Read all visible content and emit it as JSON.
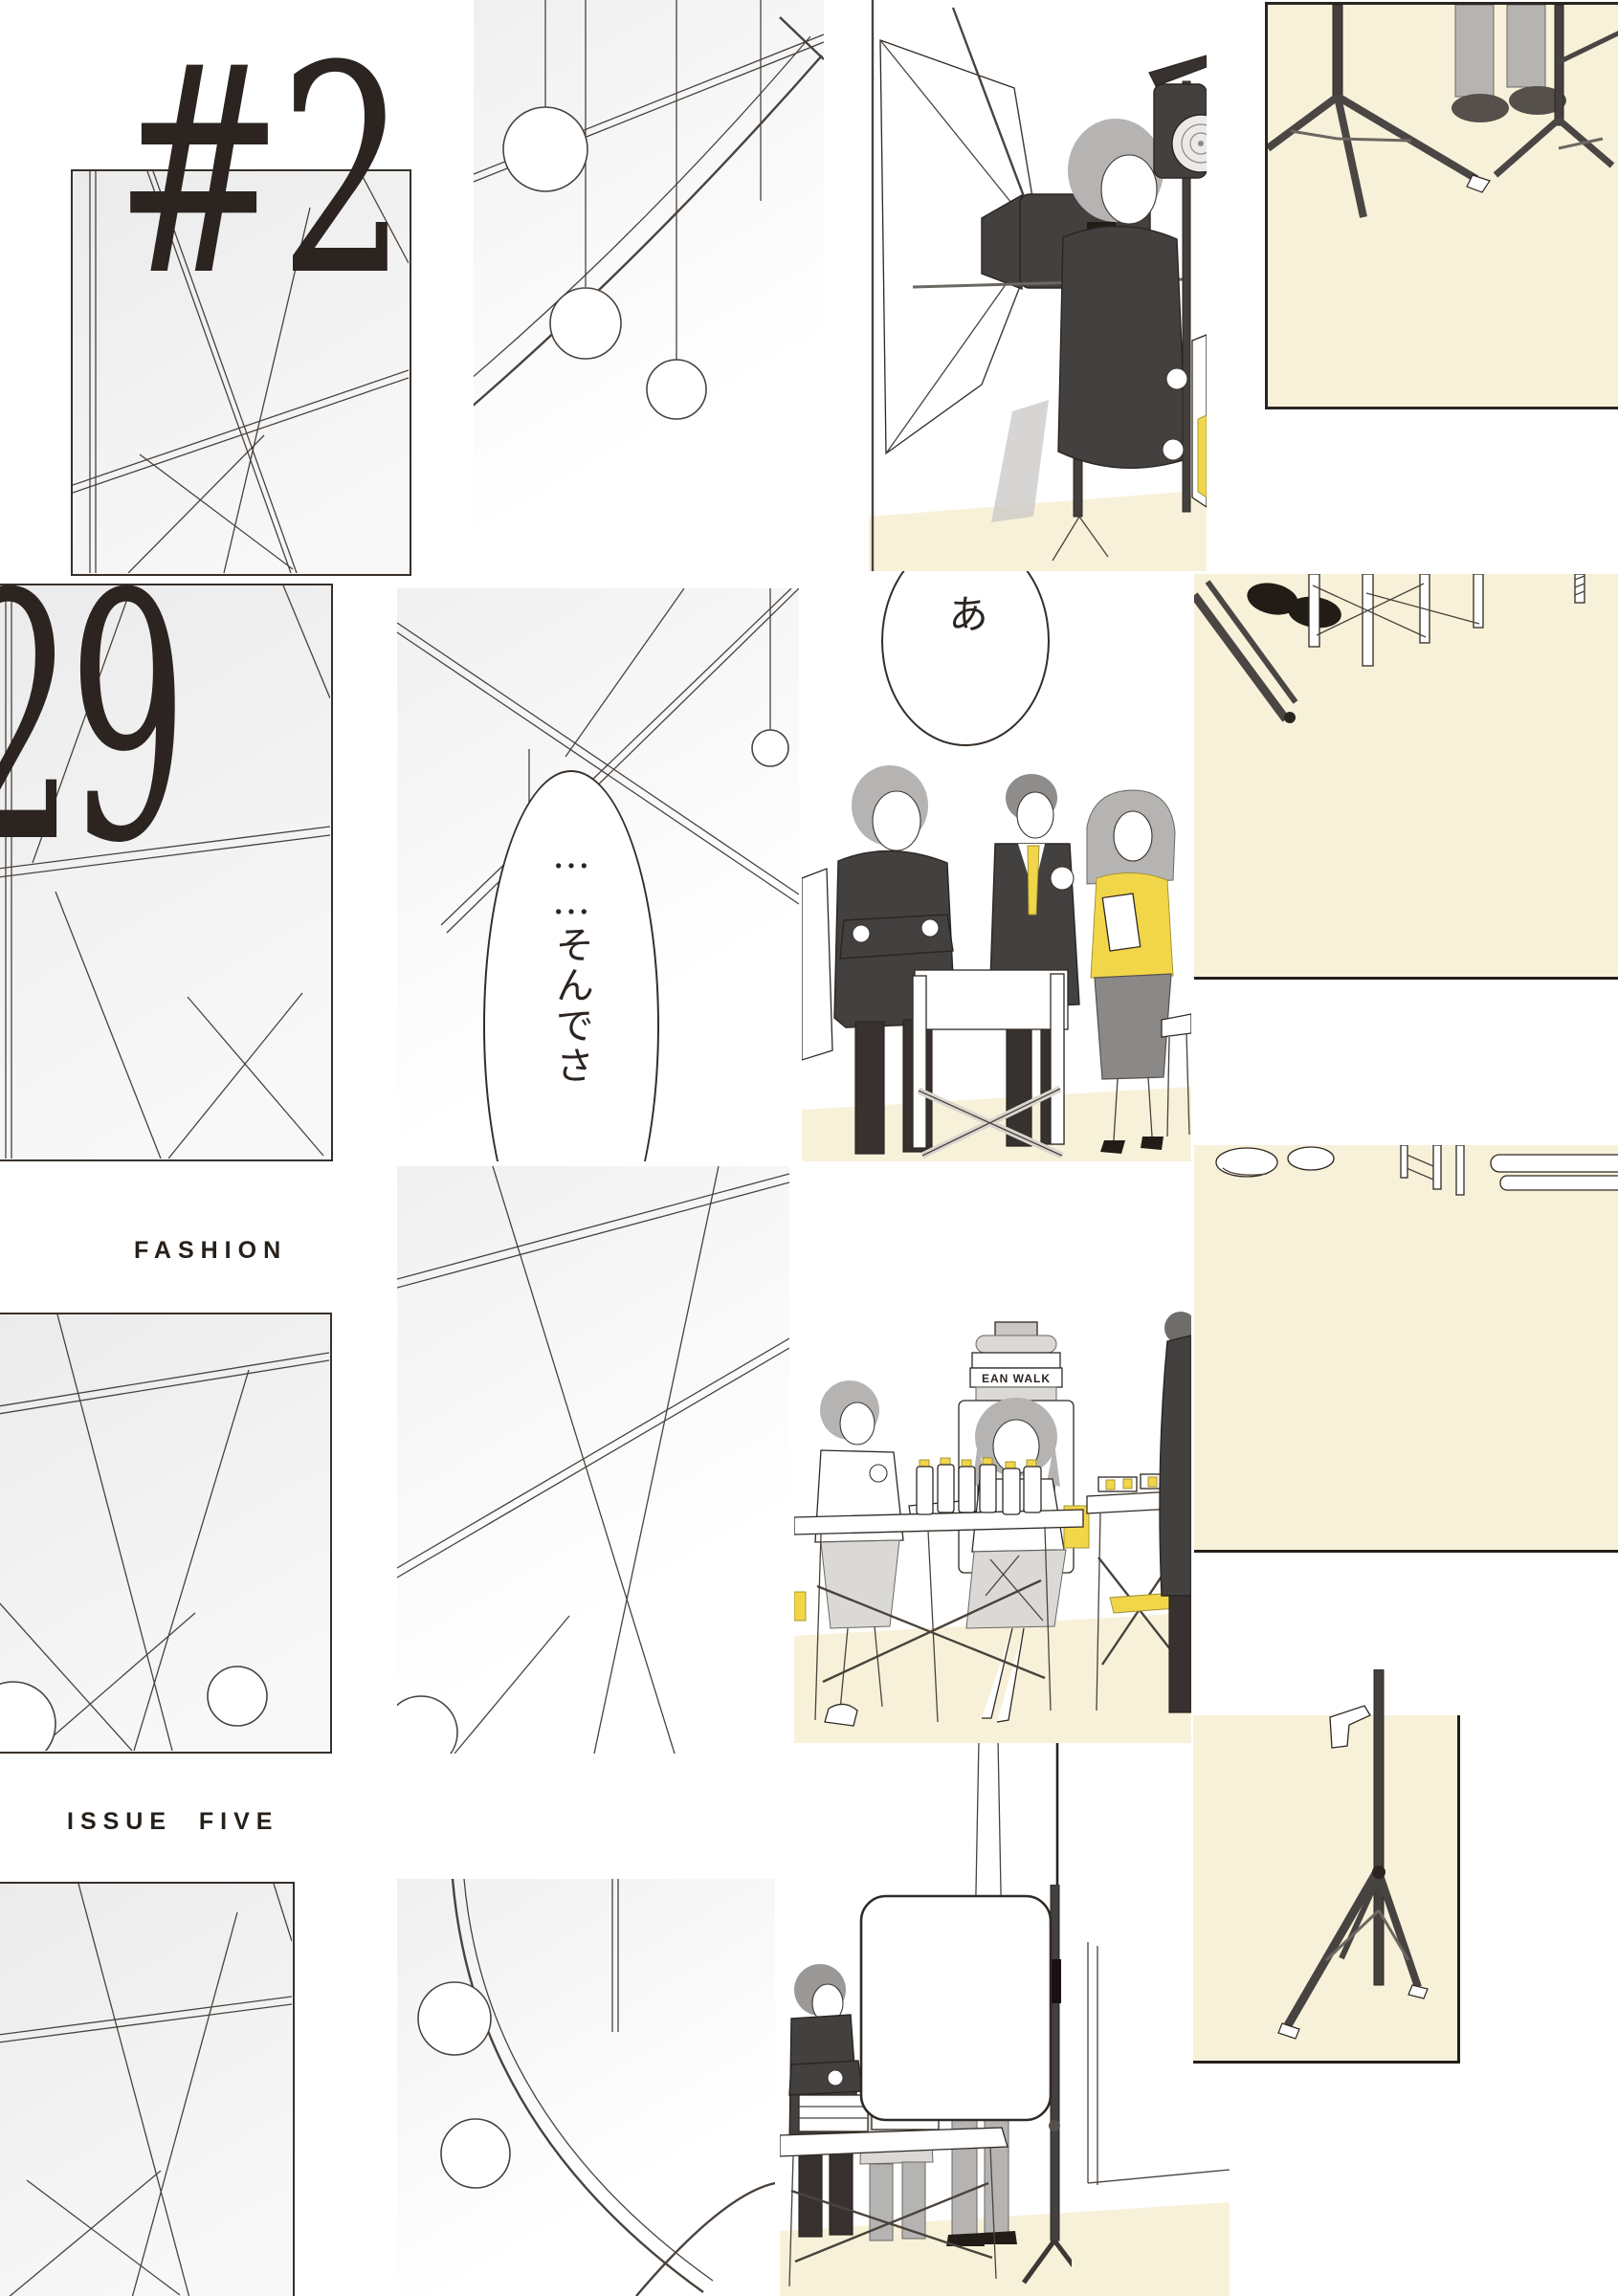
{
  "theme": {
    "background": "#ffffff",
    "ink": "#2f2822",
    "line_art": "#4a423c",
    "cream": "#f8f1d9",
    "panel_gray": "#ebebec",
    "accent_yellow": "#f2d64a",
    "dark_garment": "#434040",
    "mid_gray": "#b6b4b3",
    "border_dark": "#2b2521"
  },
  "masthead": {
    "issue_hash_fragment_top": "#2",
    "issue_number_fragment": "29",
    "category_label": "FASHION",
    "issue_label": "ISSUE  FIVE"
  },
  "speech_bubbles": {
    "main_vertical_text": "……そんでさ",
    "exclamation_text": "あ"
  },
  "props": {
    "water_cooler_brand": "EAN WALK"
  }
}
